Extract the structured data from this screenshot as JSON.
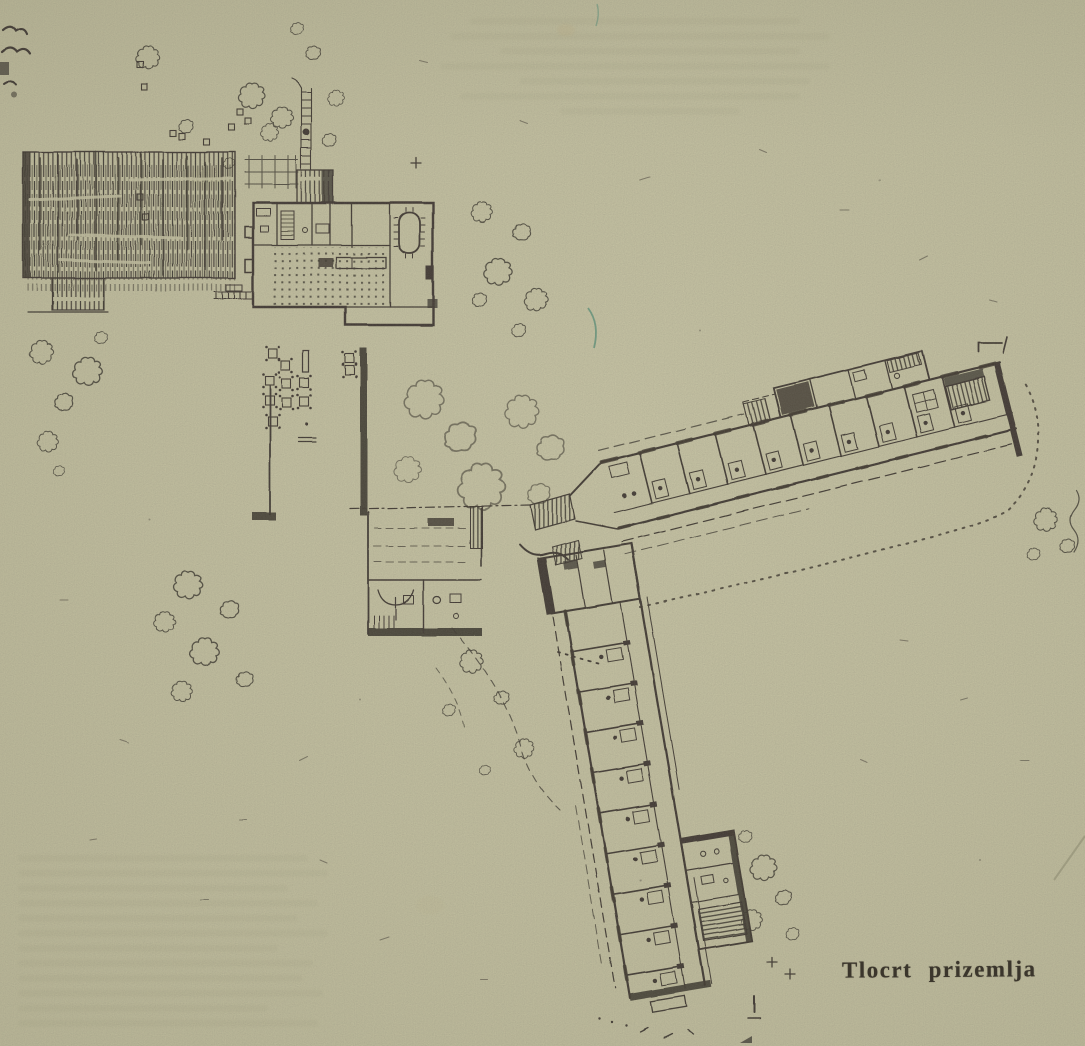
{
  "caption": {
    "text": "Tlocrt prizemlja"
  },
  "palette": {
    "paper": "#c9c6a4",
    "ink": "#312c25",
    "ink_light": "#5d574b",
    "green_pen_mark": "#57937b",
    "pencil_mark": "#8d8a6d"
  },
  "components": [
    "garden-pergola-hatch",
    "approach-path",
    "garden-beds",
    "main-pavilion",
    "dining-oval-table",
    "tiled-terrace-floor",
    "terrace-tables",
    "service-block",
    "junction-stairs",
    "guest-wing-east",
    "guest-wing-south",
    "stair-hatches",
    "dotted-footpath",
    "site-trees",
    "shrub-markers",
    "survey-marks",
    "plan-caption"
  ]
}
